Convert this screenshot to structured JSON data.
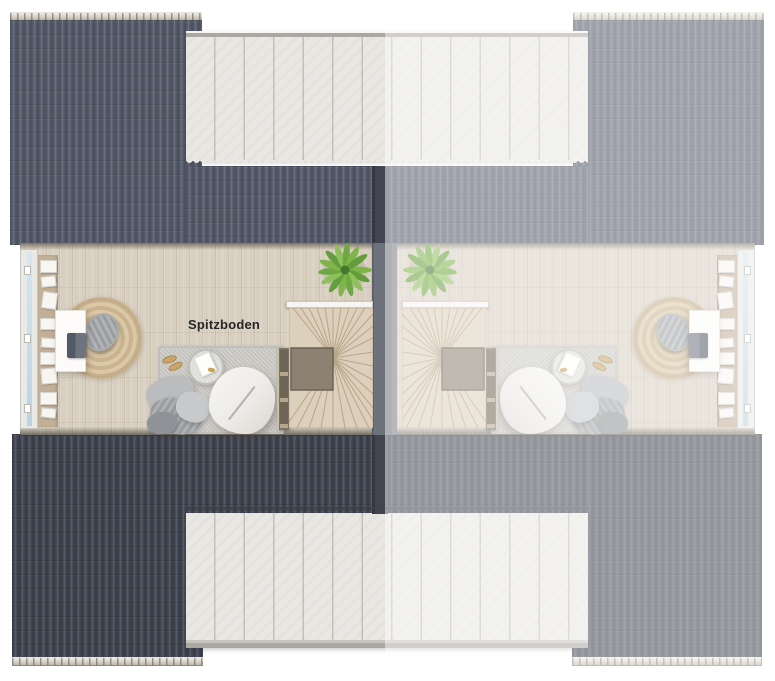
{
  "floorplan": {
    "room_label": "Spitzboden",
    "colors": {
      "roof_dark_top": "#545968",
      "roof_dark_bottom": "#3f434d",
      "ridge_cap": "#d6d1c3",
      "dormer_panel": "#e9e7e2",
      "floor_wood": "#d8cfc0",
      "party_wall": "#6e727c",
      "plant_green": "#7fb44b",
      "neighbor_fade": "rgba(255,255,255,0.45)"
    }
  }
}
